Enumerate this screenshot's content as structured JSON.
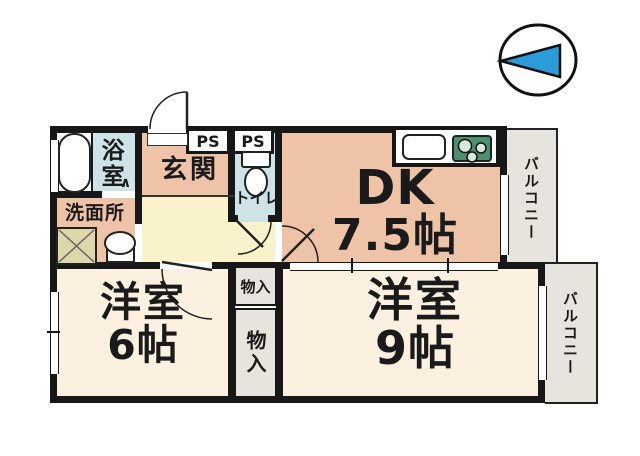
{
  "title": "間取り図",
  "colors": {
    "wall": "#171717",
    "salmon": "#eec3a7",
    "cream": "#fcf1e1",
    "hall_yellow": "#f9f2cb",
    "water_blue": "#cde3e7",
    "balcony-gray": "#e7e4de",
    "closet-gray": "#e7e4de",
    "stove-green": "#4d8f6e",
    "burner-fill": "#d9e8dd",
    "compass-blue": "#2b9cd8",
    "pan-beige": "#ddd7ab"
  },
  "compass": {
    "label": "north-arrow"
  },
  "rooms": {
    "bathroom": {
      "label": "浴室",
      "door_mark": "∧"
    },
    "washroom": {
      "label": "洗面所"
    },
    "entrance": {
      "label": "玄関"
    },
    "toilet": {
      "label": "トイレ"
    },
    "ps_left": {
      "label": "PS"
    },
    "ps_right": {
      "label": "PS"
    },
    "dk": {
      "label": "DK",
      "size": "7.5帖"
    },
    "western_room_6": {
      "label": "洋室",
      "size": "6帖"
    },
    "western_room_9": {
      "label": "洋室",
      "size": "9帖"
    },
    "closet_upper": {
      "label": "物入"
    },
    "closet_lower": {
      "label": "物入"
    },
    "balcony_top": {
      "label": "バルコニー"
    },
    "balcony_right": {
      "label": "バルコニー"
    }
  }
}
